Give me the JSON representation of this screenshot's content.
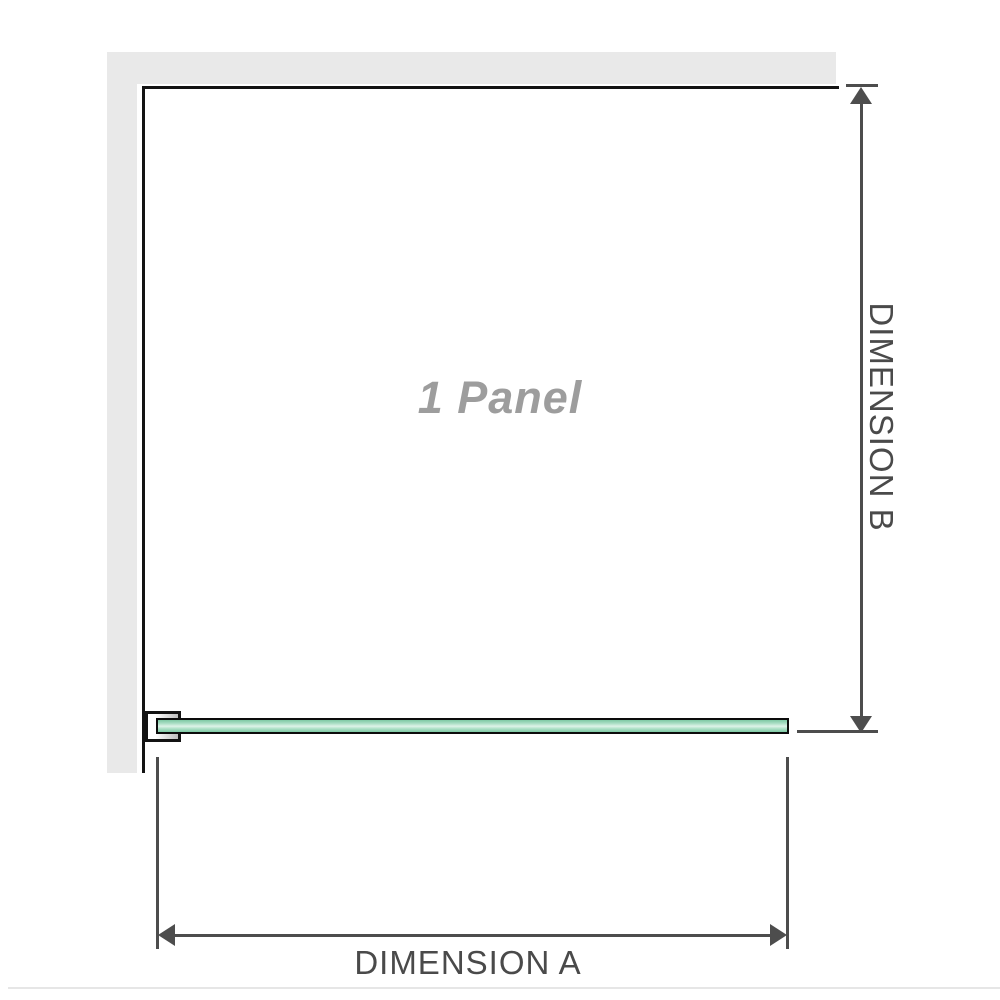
{
  "diagram": {
    "title": "1 Panel",
    "dimensions": {
      "a_label": "DIMENSION A",
      "b_label": "DIMENSION B"
    }
  },
  "colors": {
    "wall_gray": "#e9e9e9",
    "panel_edge": "#131313",
    "glass_green": "#a9dec4",
    "glass_green_light": "#ddf3e8",
    "glass_green_dark": "#7ec9a4",
    "glass_outline": "#0c0c0c",
    "dimension_line": "#4d4d4d",
    "dimension_text": "#4a4a4a",
    "panel_text_gray": "#9d9d9d",
    "divider_gray": "#e6e6e6",
    "bracket_fill_start": "#ffffff",
    "bracket_fill_end": "#bdbdbd"
  }
}
